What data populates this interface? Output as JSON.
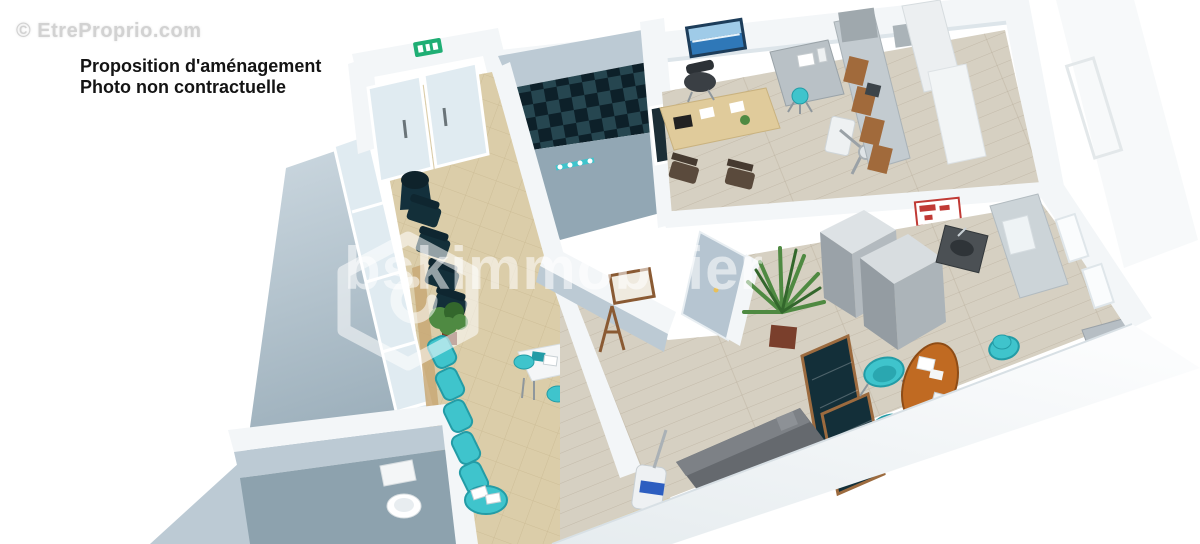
{
  "overlays": {
    "site_watermark": "© EtreProprio.com",
    "caption_line1": "Proposition d'aménagement",
    "caption_line2": "Photo non contractuelle",
    "agency_watermark": "bskimmobilier"
  },
  "icons": {
    "agency_logo": "house-outline-icon",
    "exit_sign": "emergency-exit-icon"
  },
  "colors": {
    "background": "#ffffff",
    "floor_tile": "#dbcda9",
    "tile_line": "#c6b58d",
    "floor_wood": "#d6d0c2",
    "plank_line": "#b3a895",
    "wall_face": "#f3f6f8",
    "wall_edge": "#dde5ea",
    "wall_shade": "#bccad4",
    "wall_dark": "#92a7b4",
    "wc_floor": "#8da2ae",
    "glass": "#e0ebf1",
    "teal": "#3fc4cc",
    "teal_dark": "#239ca6",
    "navy": "#132f39",
    "locker_dark": "#0d2029",
    "locker_mid": "#264650",
    "wood_brown": "#a16a3b",
    "desk_wood": "#e0cb9b",
    "table_orange": "#c06a22",
    "sofa_gray": "#65696e",
    "plant_green": "#4f8a42",
    "plant_dark": "#33672c",
    "sign_green": "#1fae74",
    "sign_red": "#c03a35",
    "device_blue": "#2d5ec0",
    "steel": "#b9c1c6",
    "steel_dark": "#8f979c",
    "watermark_gray": "#d2d2d2",
    "text_black": "#141414"
  }
}
